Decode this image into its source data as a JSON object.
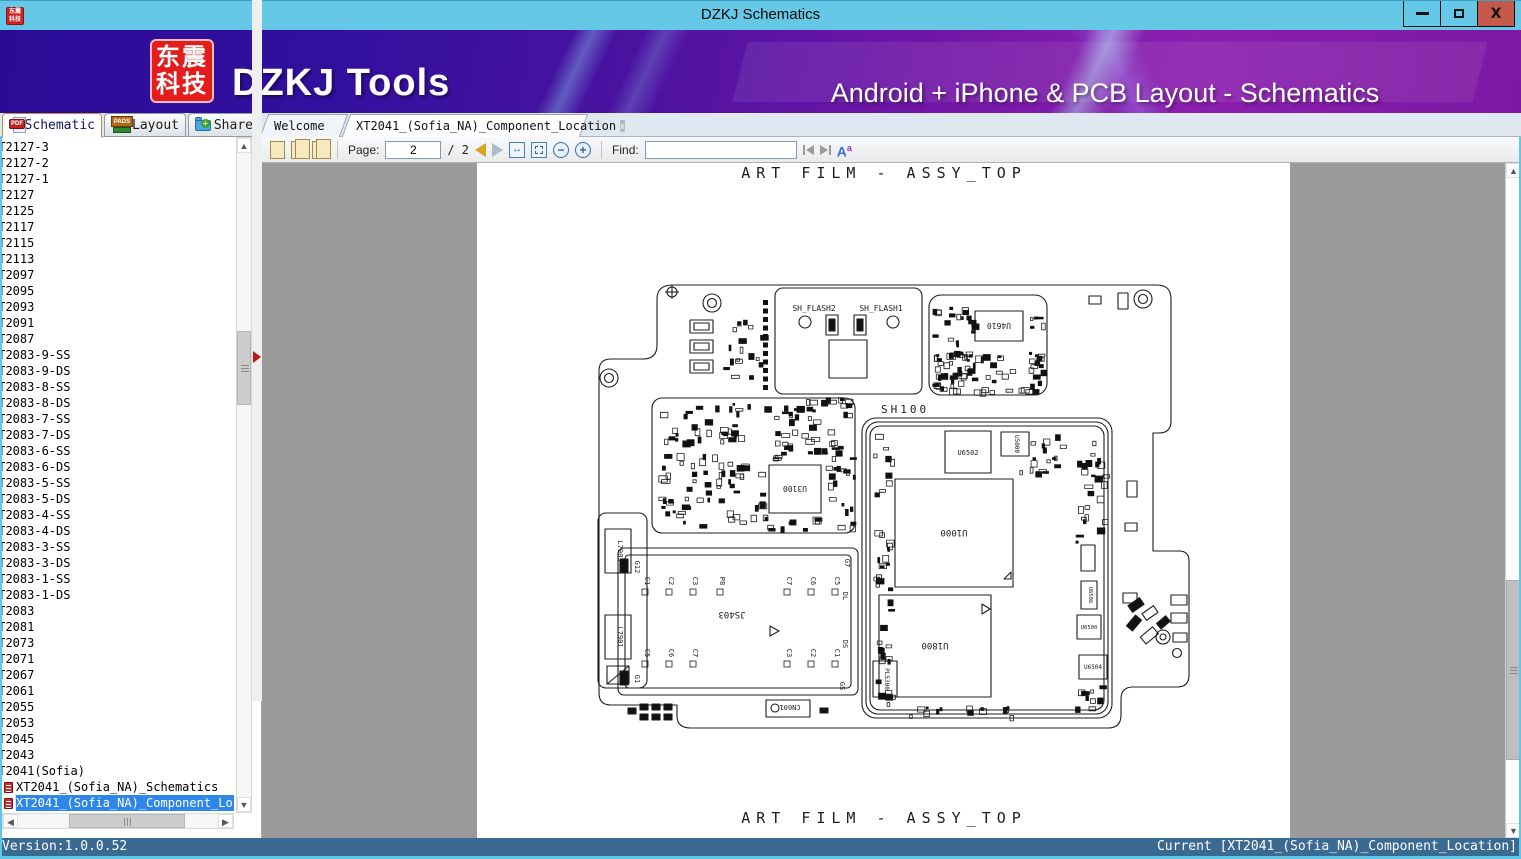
{
  "window": {
    "title": "DZKJ Schematics",
    "minimize": "–",
    "maximize": "",
    "close": "x"
  },
  "banner": {
    "logo_line1": "东震",
    "logo_line2": "科技",
    "brand": "DZKJ Tools",
    "tagline": "Android + iPhone & PCB Layout - Schematics",
    "accent_purple": "#4812a0",
    "titlebar_blue": "#65c8e7"
  },
  "tabs": [
    {
      "label": "Schematic",
      "icon": "pdf-icon",
      "active": true
    },
    {
      "label": "Layout",
      "icon": "pads-icon",
      "active": false
    },
    {
      "label": "Share",
      "icon": "share-folder-icon",
      "active": false
    }
  ],
  "doc_tabs": [
    {
      "label": "Welcome",
      "active": false
    },
    {
      "label": "XT2041_(Sofia_NA)_Component_Location",
      "active": true,
      "close": "x"
    }
  ],
  "toolbar": {
    "page_label": "Page:",
    "page_value": "2",
    "page_total": "/ 2",
    "find_label": "Find:",
    "find_value": "",
    "font_icon": "A",
    "font_icon_sup": "a"
  },
  "sidebar": {
    "items": [
      {
        "label": "XT2127-3",
        "type": "node"
      },
      {
        "label": "XT2127-2",
        "type": "node"
      },
      {
        "label": "XT2127-1",
        "type": "node"
      },
      {
        "label": "XT2127",
        "type": "node"
      },
      {
        "label": "XT2125",
        "type": "node"
      },
      {
        "label": "XT2117",
        "type": "node"
      },
      {
        "label": "XT2115",
        "type": "node"
      },
      {
        "label": "XT2113",
        "type": "node"
      },
      {
        "label": "XT2097",
        "type": "node"
      },
      {
        "label": "XT2095",
        "type": "node"
      },
      {
        "label": "XT2093",
        "type": "node"
      },
      {
        "label": "XT2091",
        "type": "node"
      },
      {
        "label": "XT2087",
        "type": "node"
      },
      {
        "label": "XT2083-9-SS",
        "type": "node"
      },
      {
        "label": "XT2083-9-DS",
        "type": "node"
      },
      {
        "label": "XT2083-8-SS",
        "type": "node"
      },
      {
        "label": "XT2083-8-DS",
        "type": "node"
      },
      {
        "label": "XT2083-7-SS",
        "type": "node"
      },
      {
        "label": "XT2083-7-DS",
        "type": "node"
      },
      {
        "label": "XT2083-6-SS",
        "type": "node"
      },
      {
        "label": "XT2083-6-DS",
        "type": "node"
      },
      {
        "label": "XT2083-5-SS",
        "type": "node"
      },
      {
        "label": "XT2083-5-DS",
        "type": "node"
      },
      {
        "label": "XT2083-4-SS",
        "type": "node"
      },
      {
        "label": "XT2083-4-DS",
        "type": "node"
      },
      {
        "label": "XT2083-3-SS",
        "type": "node"
      },
      {
        "label": "XT2083-3-DS",
        "type": "node"
      },
      {
        "label": "XT2083-1-SS",
        "type": "node"
      },
      {
        "label": "XT2083-1-DS",
        "type": "node"
      },
      {
        "label": "XT2083",
        "type": "node"
      },
      {
        "label": "XT2081",
        "type": "node"
      },
      {
        "label": "XT2073",
        "type": "node"
      },
      {
        "label": "XT2071",
        "type": "node"
      },
      {
        "label": "XT2067",
        "type": "node"
      },
      {
        "label": "XT2061",
        "type": "node"
      },
      {
        "label": "XT2055",
        "type": "node"
      },
      {
        "label": "XT2053",
        "type": "node"
      },
      {
        "label": "XT2045",
        "type": "node"
      },
      {
        "label": "XT2043",
        "type": "node"
      },
      {
        "label": "XT2041(Sofia)",
        "type": "node"
      },
      {
        "label": "XT2041_(Sofia_NA)_Schematics",
        "type": "doc"
      },
      {
        "label": "XT2041_(Sofia_NA)_Component_Location",
        "type": "doc",
        "selected": true
      }
    ]
  },
  "statusbar": {
    "version": "Version:1.0.0.52",
    "current": "Current [XT2041_(Sofia_NA)_Component_Location]"
  },
  "pcb": {
    "title_top": "ART FILM - ASSY_TOP",
    "title_bottom": "ART FILM - ASSY_TOP",
    "labels": {
      "sh_flash2": "SH_FLASH2",
      "sh_flash1": "SH_FLASH1",
      "sh100": "SH100",
      "u6502": "U6502",
      "u5000": "U5000",
      "u1000": "U1000",
      "u1800": "U1800",
      "pl5300": "PL5300",
      "u6506": "U6506",
      "u6500": "U6500",
      "u6504": "U6504",
      "u4610": "U4610",
      "u3100": "U3100",
      "l7903": "L7903",
      "l7901": "L7901",
      "js403": "JS403",
      "cn601": "CN601",
      "g12": "G12",
      "g1": "G1",
      "g7": "G7",
      "dl": "DL",
      "ds": "DS",
      "gs": "GS"
    },
    "connector_pins_top": [
      "C1",
      "C2",
      "C3",
      "P8",
      "C7",
      "C6",
      "C5"
    ],
    "connector_pins_bottom": [
      "C5",
      "C6",
      "C7",
      "C3",
      "C2",
      "C1"
    ]
  }
}
